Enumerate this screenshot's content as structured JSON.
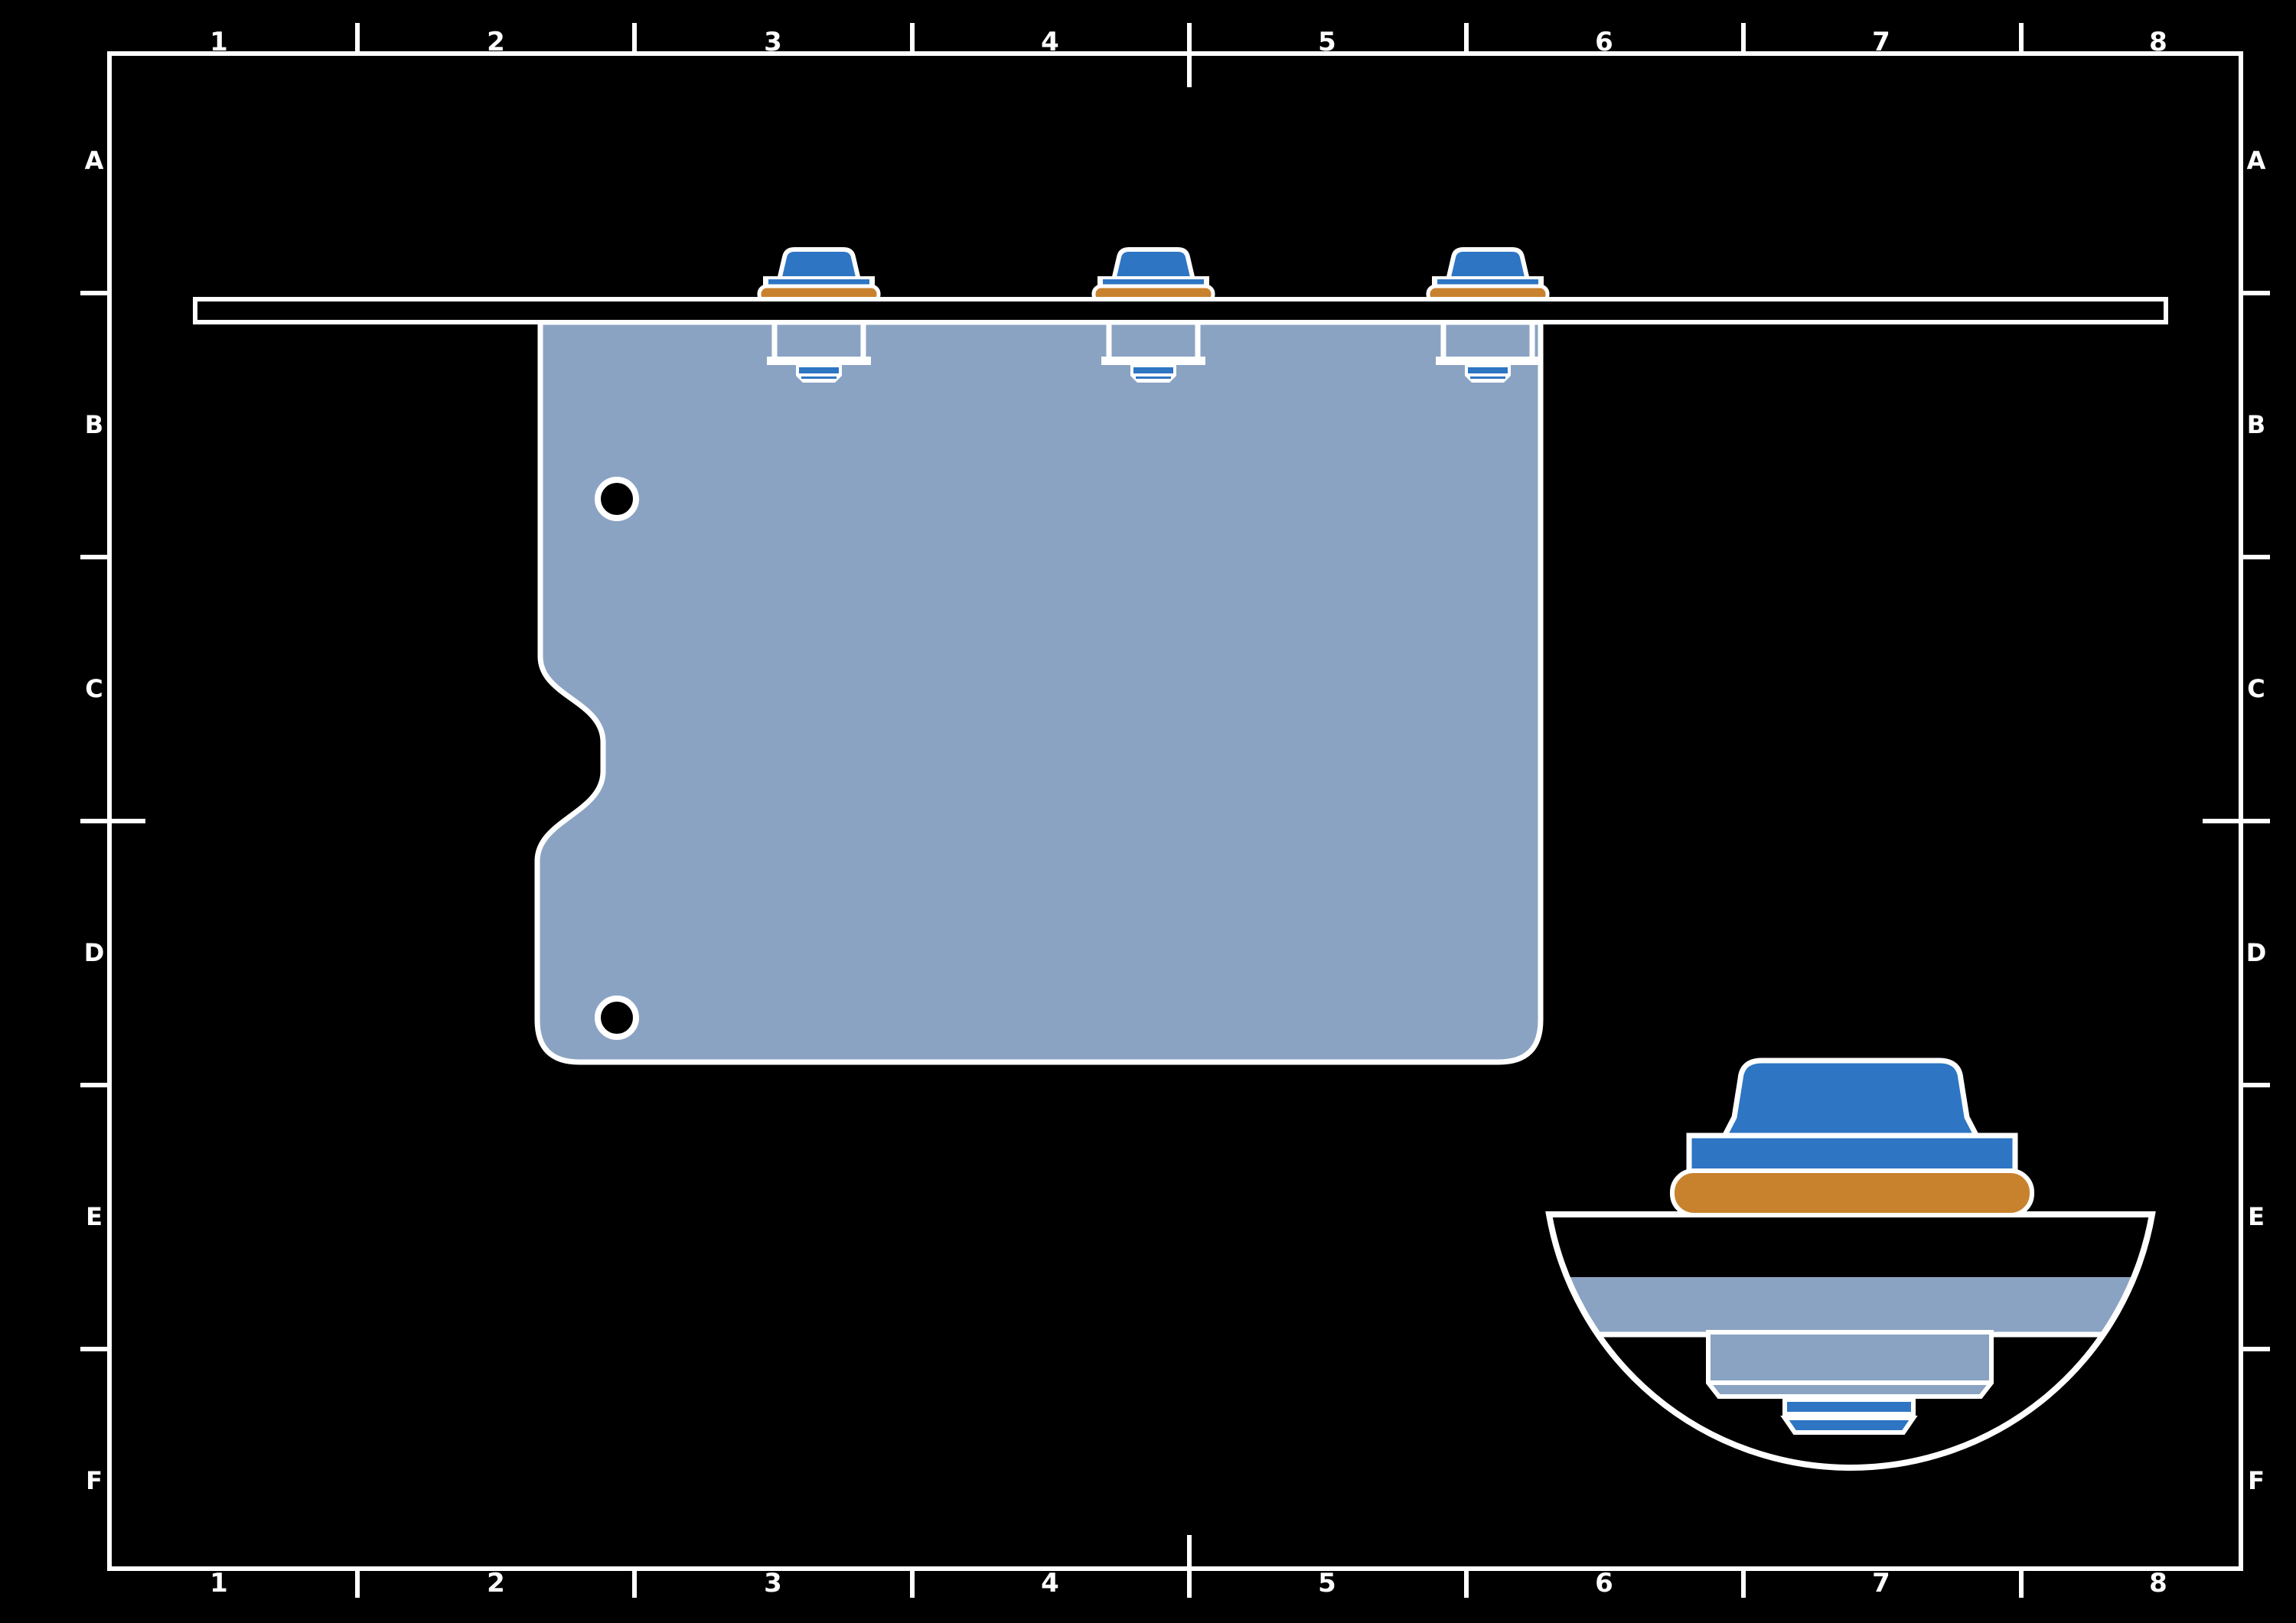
{
  "frame": {
    "column_labels": [
      "1",
      "2",
      "3",
      "4",
      "5",
      "6",
      "7",
      "8"
    ],
    "row_labels": [
      "A",
      "B",
      "C",
      "D",
      "E",
      "F"
    ]
  },
  "colors": {
    "background": "#000000",
    "line": "#ffffff",
    "fastener_blue": "#2E75C4",
    "washer_orange": "#C8822E",
    "panel_blue_gray": "#8BA3C3"
  }
}
